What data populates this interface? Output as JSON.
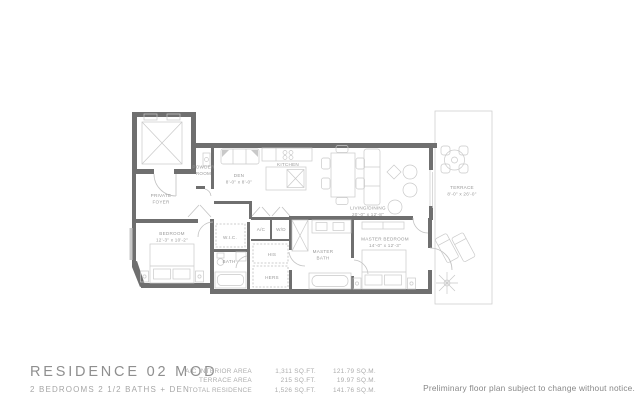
{
  "residence": {
    "title": "RESIDENCE 02 MOD",
    "subtitle": "2 BEDROOMS 2 1/2 BATHS + DEN"
  },
  "areas": {
    "rows": [
      {
        "label": "A/C INTERIOR AREA",
        "sqft": "1,311 SQ.FT.",
        "sqm": "121.79 SQ.M."
      },
      {
        "label": "TERRACE AREA",
        "sqft": "215 SQ.FT.",
        "sqm": "19.97 SQ.M."
      },
      {
        "label": "TOTAL RESIDENCE",
        "sqft": "1,526 SQ.FT.",
        "sqm": "141.76 SQ.M."
      }
    ]
  },
  "disclaimer": "Preliminary floor plan subject to change without notice.",
  "rooms": {
    "powder": {
      "line1": "POWDER",
      "line2": "ROOM"
    },
    "foyer": {
      "line1": "PRIVATE",
      "line2": "FOYER"
    },
    "den": {
      "name": "DEN",
      "dims": "8'-0\" x 8'-0\""
    },
    "kitchen": {
      "name": "KITCHEN"
    },
    "living": {
      "name": "LIVING/DINING",
      "dims": "20'-0\" x 12'-8\""
    },
    "terrace": {
      "name": "TERRACE",
      "dims": "8'-0\" x 26'-0\""
    },
    "bedroom": {
      "name": "BEDROOM",
      "dims": "12'-3\" x 10'-2\""
    },
    "wic": {
      "name": "W.I.C."
    },
    "bath": {
      "name": "BATH"
    },
    "ac": {
      "name": "A/C"
    },
    "wd": {
      "name": "W/D"
    },
    "his": {
      "name": "HIS"
    },
    "hers": {
      "name": "HERS"
    },
    "master_bath": {
      "line1": "MASTER",
      "line2": "BATH"
    },
    "master_bedroom": {
      "name": "MASTER BEDROOM",
      "dims": "14'-0\" x 12'-3\""
    }
  },
  "colors": {
    "wall": "#6f6f6f",
    "fixture": "#bdbdbd",
    "label": "#9a9a9a",
    "title_text": "#8f8f8f",
    "disclaimer_text": "#878787"
  }
}
